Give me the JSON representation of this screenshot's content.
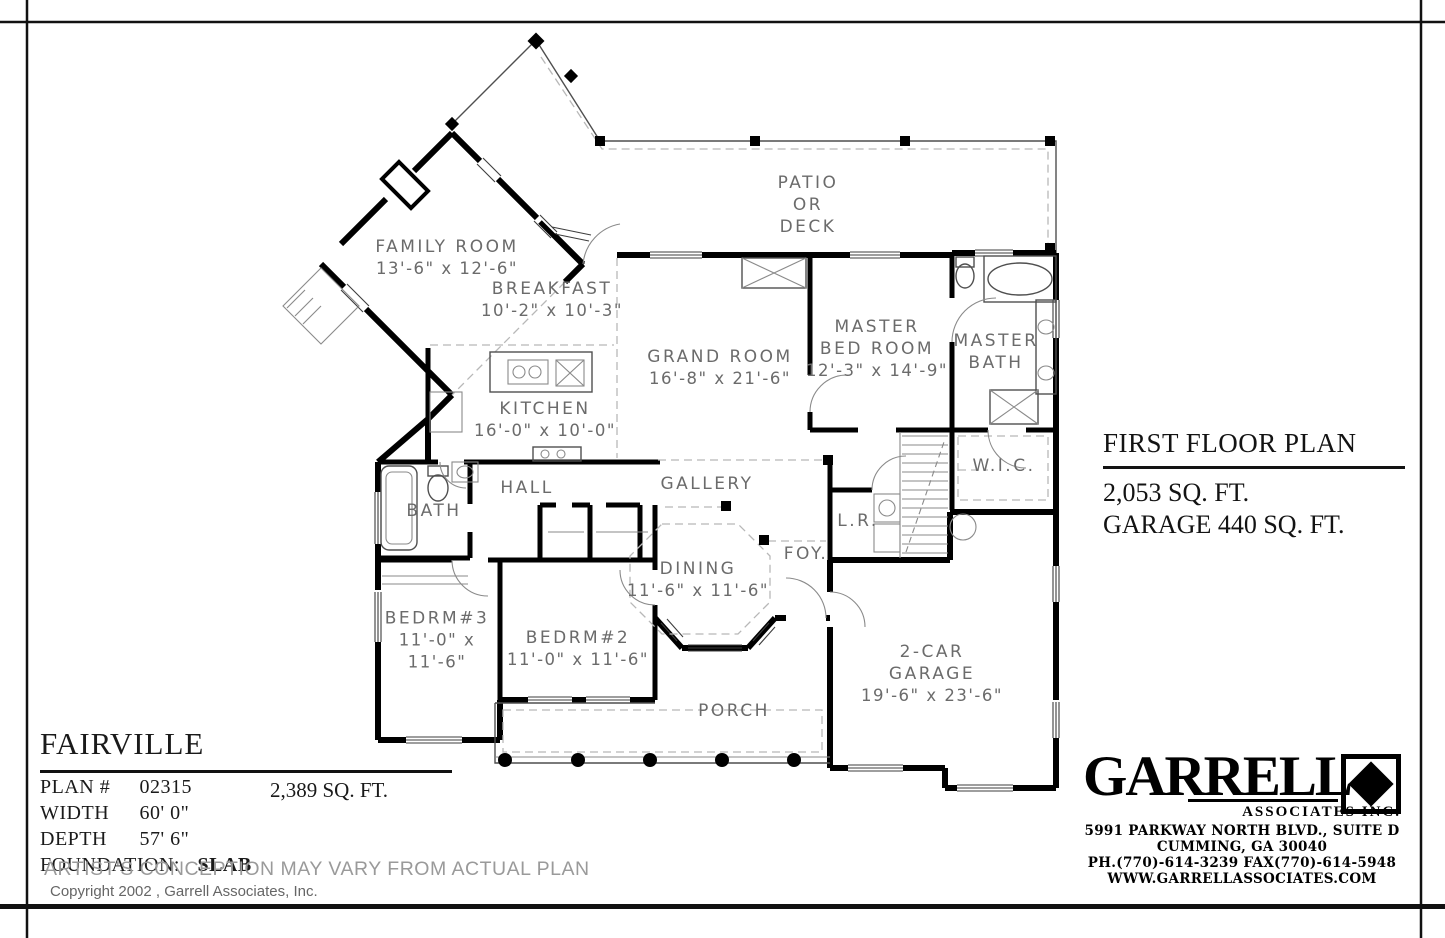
{
  "rooms": [
    {
      "name": "PATIO\nOR\nDECK",
      "dims": ""
    },
    {
      "name": "FAMILY ROOM",
      "dims": "13'-6\" x 12'-6\""
    },
    {
      "name": "BREAKFAST",
      "dims": "10'-2\" x 10'-3\""
    },
    {
      "name": "GRAND ROOM",
      "dims": "16'-8\" x 21'-6\""
    },
    {
      "name": "MASTER\nBED ROOM",
      "dims": "12'-3\" x 14'-9\""
    },
    {
      "name": "MASTER\nBATH",
      "dims": ""
    },
    {
      "name": "KITCHEN",
      "dims": "16'-0\" x 10'-0\""
    },
    {
      "name": "W.I.C.",
      "dims": ""
    },
    {
      "name": "HALL",
      "dims": ""
    },
    {
      "name": "GALLERY",
      "dims": ""
    },
    {
      "name": "BATH",
      "dims": ""
    },
    {
      "name": "L.R.",
      "dims": ""
    },
    {
      "name": "DINING",
      "dims": "11'-6\" x 11'-6\""
    },
    {
      "name": "FOY.",
      "dims": ""
    },
    {
      "name": "BEDRM#3",
      "dims": "11'-0\" x\n11'-6\""
    },
    {
      "name": "BEDRM#2",
      "dims": "11'-0\" x 11'-6\""
    },
    {
      "name": "PORCH",
      "dims": ""
    },
    {
      "name": "2-CAR\nGARAGE",
      "dims": "19'-6\" x 23'-6\""
    }
  ],
  "plan_title": {
    "title": "FIRST FLOOR PLAN",
    "area": "2,053  SQ. FT.",
    "garage_area": "GARAGE  440 SQ. FT."
  },
  "title_block": {
    "plan_name": "FAIRVILLE",
    "plan_no_label": "PLAN #",
    "plan_no": "02315",
    "area": "2,389  SQ. FT.",
    "width_label": "WIDTH",
    "width": "60' 0\"",
    "depth_label": "DEPTH",
    "depth": "57' 6\"",
    "foundation_label": "FOUNDATION:",
    "foundation": "SLAB",
    "disclaimer": "ARTIST'S CONCEPTION MAY VARY FROM ACTUAL PLAN",
    "copyright": "Copyright 2002 , Garrell Associates, Inc."
  },
  "logo": {
    "name": "GARRELL",
    "subtitle": "ASSOCIATES INC.",
    "address_line1": "5991 PARKWAY NORTH BLVD., SUITE D",
    "address_line2": "CUMMING, GA 30040",
    "phone_fax": "PH.(770)-614-3239 FAX(770)-614-5948",
    "website": "WWW.GARRELLASSOCIATES.COM",
    "logo_mark": "diamond-in-square"
  },
  "colors": {
    "wall": "#000000",
    "label_text": "#6b6b6b",
    "thin_line": "#4f4f4f",
    "dashed_line": "#b8b8b8",
    "disclaimer_text": "#9a9a9a",
    "background": "#ffffff"
  }
}
